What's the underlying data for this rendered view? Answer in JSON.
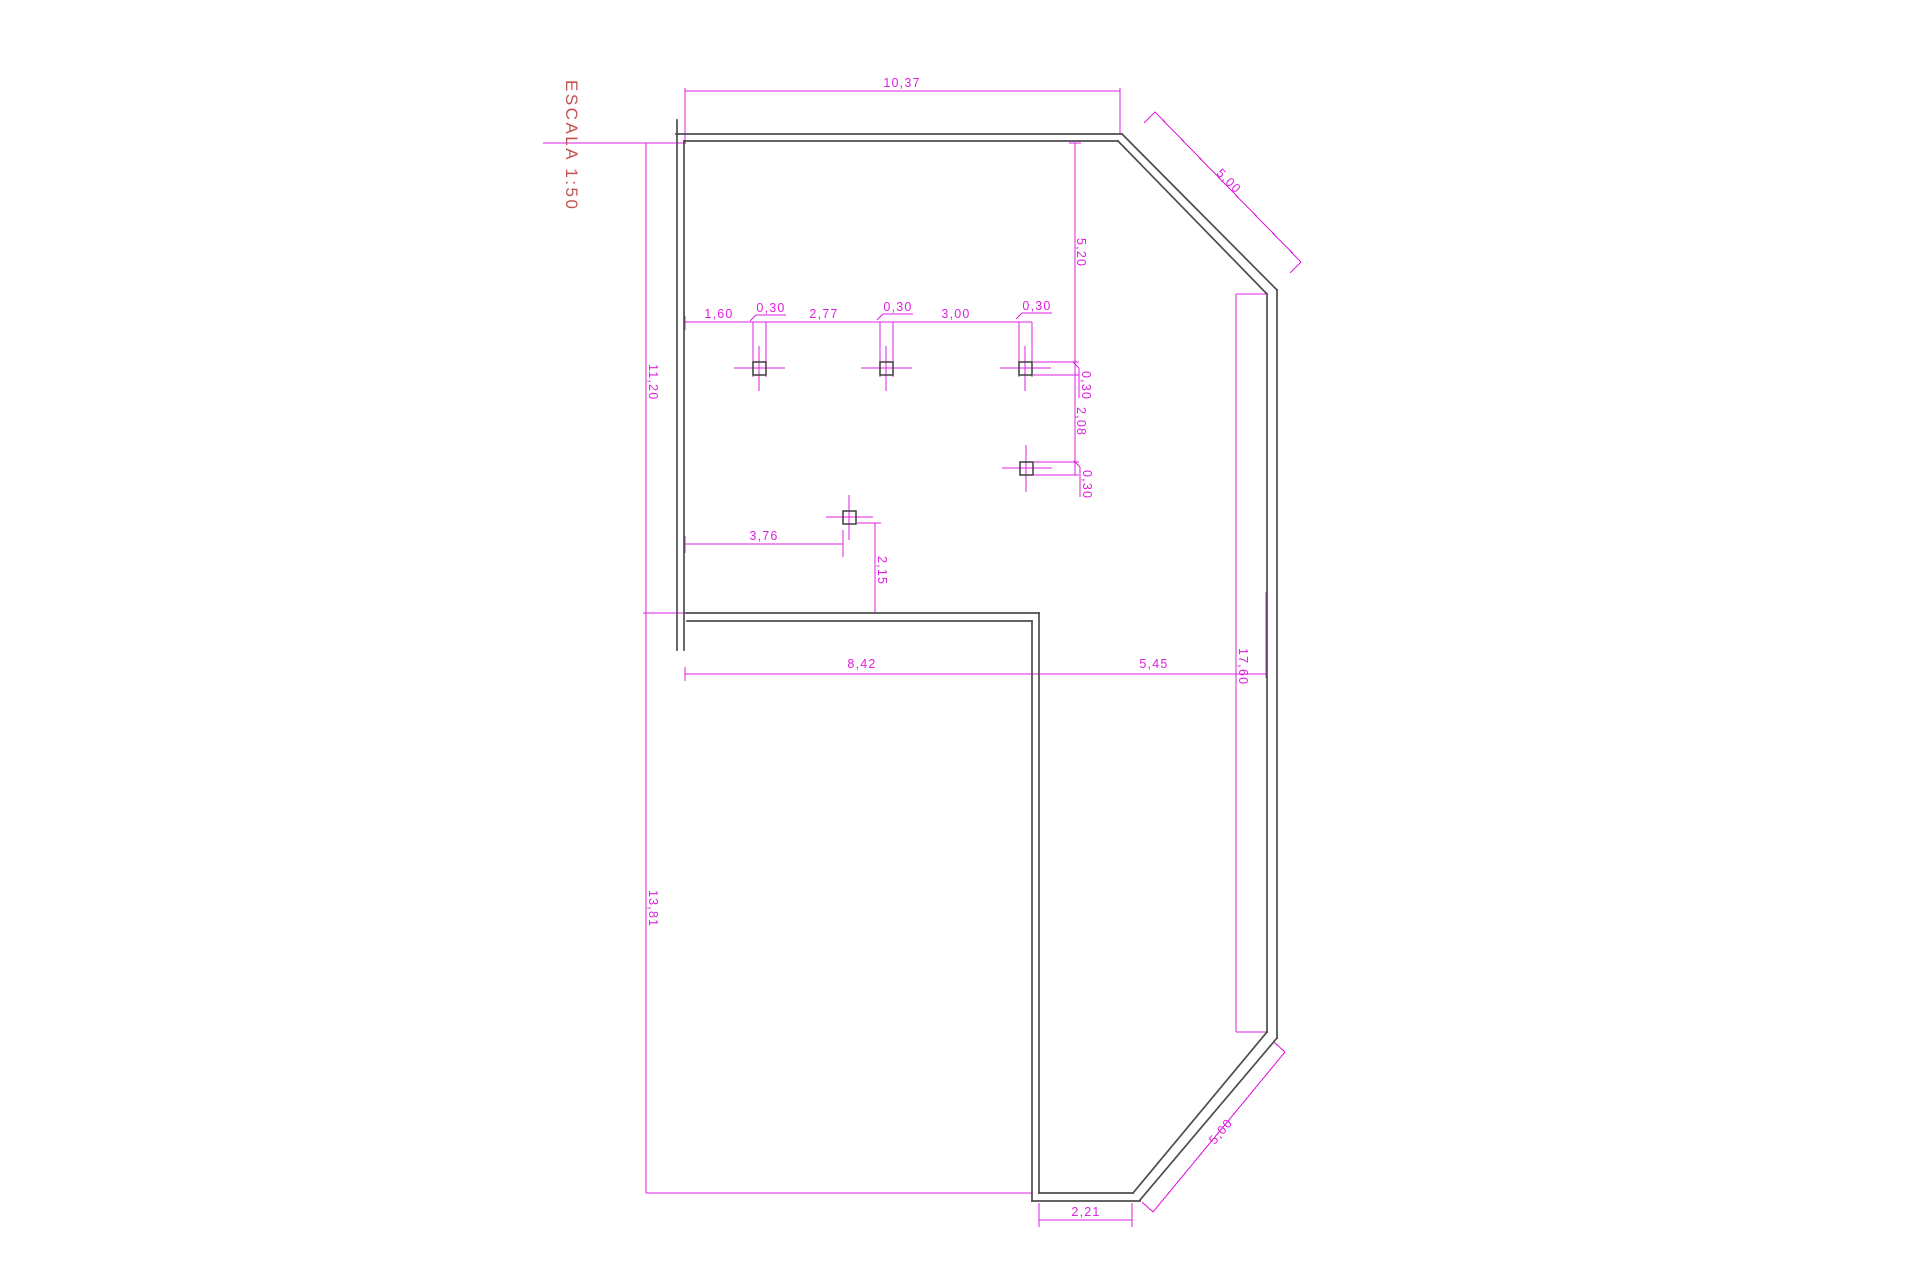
{
  "page": {
    "background": "#ffffff",
    "width": 1920,
    "height": 1280
  },
  "scale_annotation": {
    "text": "ESCALA  1:50",
    "color": "#c1534e",
    "x": 566,
    "y": 80,
    "rotation": 90,
    "font_size": 17,
    "letter_spacing": 2.5
  },
  "drawing": {
    "type": "floor-plan",
    "colors": {
      "dimension": "#df1fdf",
      "wall": "#4d4d4d",
      "column": "#3d3d3d"
    },
    "wall_lines": [
      [
        676,
        134,
        1122,
        134
      ],
      [
        684,
        141,
        1118,
        141
      ],
      [
        677,
        120,
        677,
        650
      ],
      [
        684,
        141,
        684,
        650
      ],
      [
        1122,
        134,
        1277,
        290
      ],
      [
        1118,
        141,
        1267,
        294
      ],
      [
        1277,
        290,
        1277,
        1038
      ],
      [
        1267,
        294,
        1267,
        1032
      ],
      [
        1277,
        1038,
        1140,
        1200
      ],
      [
        1267,
        1032,
        1133,
        1193
      ],
      [
        1039,
        1193,
        1133,
        1193
      ],
      [
        1032,
        1201,
        1140,
        1201
      ],
      [
        1032,
        621,
        1032,
        1201
      ],
      [
        1039,
        613,
        1039,
        1193
      ],
      [
        686,
        613,
        1039,
        613
      ],
      [
        687,
        621,
        1032,
        621
      ]
    ],
    "column_markers": [
      {
        "x": 753,
        "y": 362,
        "size": 13
      },
      {
        "x": 880,
        "y": 362,
        "size": 13
      },
      {
        "x": 1019,
        "y": 362,
        "size": 13
      },
      {
        "x": 1020,
        "y": 462,
        "size": 13
      },
      {
        "x": 843,
        "y": 511,
        "size": 13
      }
    ],
    "dimension_lines": [
      [
        685,
        91,
        1120,
        91
      ],
      [
        685,
        88,
        685,
        144
      ],
      [
        1120,
        88,
        1120,
        134
      ],
      [
        543,
        143,
        686,
        143
      ],
      [
        646,
        143,
        646,
        1193
      ],
      [
        643,
        613,
        1040,
        613
      ],
      [
        646,
        1193,
        1032,
        1193
      ],
      [
        677,
        143,
        677,
        613
      ],
      [
        685,
        322,
        1032,
        322
      ],
      [
        685,
        316,
        685,
        330
      ],
      [
        753,
        322,
        753,
        377
      ],
      [
        766,
        322,
        766,
        377
      ],
      [
        880,
        322,
        880,
        377
      ],
      [
        893,
        322,
        893,
        377
      ],
      [
        1019,
        322,
        1019,
        377
      ],
      [
        1032,
        322,
        1032,
        377
      ],
      [
        756,
        315,
        786,
        315
      ],
      [
        756,
        315,
        750,
        321
      ],
      [
        883,
        314,
        913,
        314
      ],
      [
        883,
        314,
        877,
        320
      ],
      [
        1022,
        313,
        1052,
        313
      ],
      [
        1022,
        313,
        1016,
        319
      ],
      [
        1075,
        143,
        1075,
        475
      ],
      [
        1069,
        143,
        1081,
        143
      ],
      [
        1033,
        362,
        1079,
        362
      ],
      [
        1033,
        375,
        1079,
        375
      ],
      [
        1034,
        462,
        1079,
        462
      ],
      [
        1034,
        475,
        1079,
        475
      ],
      [
        1079,
        368,
        1079,
        398
      ],
      [
        1079,
        368,
        1073,
        362
      ],
      [
        1080,
        467,
        1080,
        497
      ],
      [
        1080,
        467,
        1074,
        461
      ],
      [
        1155,
        112,
        1301,
        262
      ],
      [
        1155,
        112,
        1144,
        123
      ],
      [
        1301,
        262,
        1290,
        273
      ],
      [
        685,
        544,
        843,
        544
      ],
      [
        685,
        536,
        685,
        553
      ],
      [
        843,
        530,
        843,
        557
      ],
      [
        875,
        523,
        875,
        613
      ],
      [
        857,
        523,
        881,
        523
      ],
      [
        685,
        674,
        1267,
        674
      ],
      [
        685,
        667,
        685,
        681
      ],
      [
        1266,
        592,
        1266,
        678
      ],
      [
        1236,
        294,
        1236,
        1032
      ],
      [
        1236,
        294,
        1267,
        294
      ],
      [
        1236,
        1032,
        1267,
        1032
      ],
      [
        1285,
        1052,
        1153,
        1212
      ],
      [
        1285,
        1052,
        1274,
        1042
      ],
      [
        1153,
        1212,
        1142,
        1202
      ],
      [
        1039,
        1220,
        1132,
        1220
      ],
      [
        1039,
        1203,
        1039,
        1227
      ],
      [
        1132,
        1203,
        1132,
        1227
      ],
      [
        734,
        368,
        785,
        368
      ],
      [
        759,
        346,
        759,
        391
      ],
      [
        861,
        368,
        912,
        368
      ],
      [
        886,
        346,
        886,
        391
      ],
      [
        1000,
        368,
        1051,
        368
      ],
      [
        1025,
        346,
        1025,
        391
      ],
      [
        1002,
        468,
        1052,
        468
      ],
      [
        1026,
        445,
        1026,
        492
      ],
      [
        826,
        517,
        873,
        517
      ],
      [
        849,
        495,
        849,
        540
      ]
    ],
    "dimension_labels": [
      {
        "text": "10,37",
        "x": 902,
        "y": 87,
        "rotation": 0
      },
      {
        "text": "1,60",
        "x": 719,
        "y": 318,
        "rotation": 0
      },
      {
        "text": "0,30",
        "x": 771,
        "y": 312,
        "rotation": 0,
        "underline": true
      },
      {
        "text": "2,77",
        "x": 824,
        "y": 318,
        "rotation": 0
      },
      {
        "text": "0,30",
        "x": 898,
        "y": 311,
        "rotation": 0,
        "underline": true
      },
      {
        "text": "3,00",
        "x": 956,
        "y": 318,
        "rotation": 0
      },
      {
        "text": "0,30",
        "x": 1037,
        "y": 310,
        "rotation": 0,
        "underline": true
      },
      {
        "text": "5,20",
        "x": 1077,
        "y": 238,
        "rotation": 90
      },
      {
        "text": "0,30",
        "x": 1082,
        "y": 371,
        "rotation": 90,
        "underline": true
      },
      {
        "text": "2,08",
        "x": 1077,
        "y": 407,
        "rotation": 90
      },
      {
        "text": "0,30",
        "x": 1083,
        "y": 470,
        "rotation": 90,
        "underline": true
      },
      {
        "text": "11,20",
        "x": 649,
        "y": 364,
        "rotation": 90
      },
      {
        "text": "13,81",
        "x": 649,
        "y": 890,
        "rotation": 90
      },
      {
        "text": "3,76",
        "x": 764,
        "y": 540,
        "rotation": 0
      },
      {
        "text": "2,15",
        "x": 878,
        "y": 556,
        "rotation": 90
      },
      {
        "text": "8,42",
        "x": 862,
        "y": 668,
        "rotation": 0
      },
      {
        "text": "5,45",
        "x": 1154,
        "y": 668,
        "rotation": 0
      },
      {
        "text": "17,60",
        "x": 1239,
        "y": 648,
        "rotation": 90
      },
      {
        "text": "5,00",
        "x": 1226,
        "y": 184,
        "rotation": 45
      },
      {
        "text": "5,00",
        "x": 1224,
        "y": 1134,
        "rotation": -50
      },
      {
        "text": "2,21",
        "x": 1086,
        "y": 1216,
        "rotation": 0
      }
    ]
  }
}
